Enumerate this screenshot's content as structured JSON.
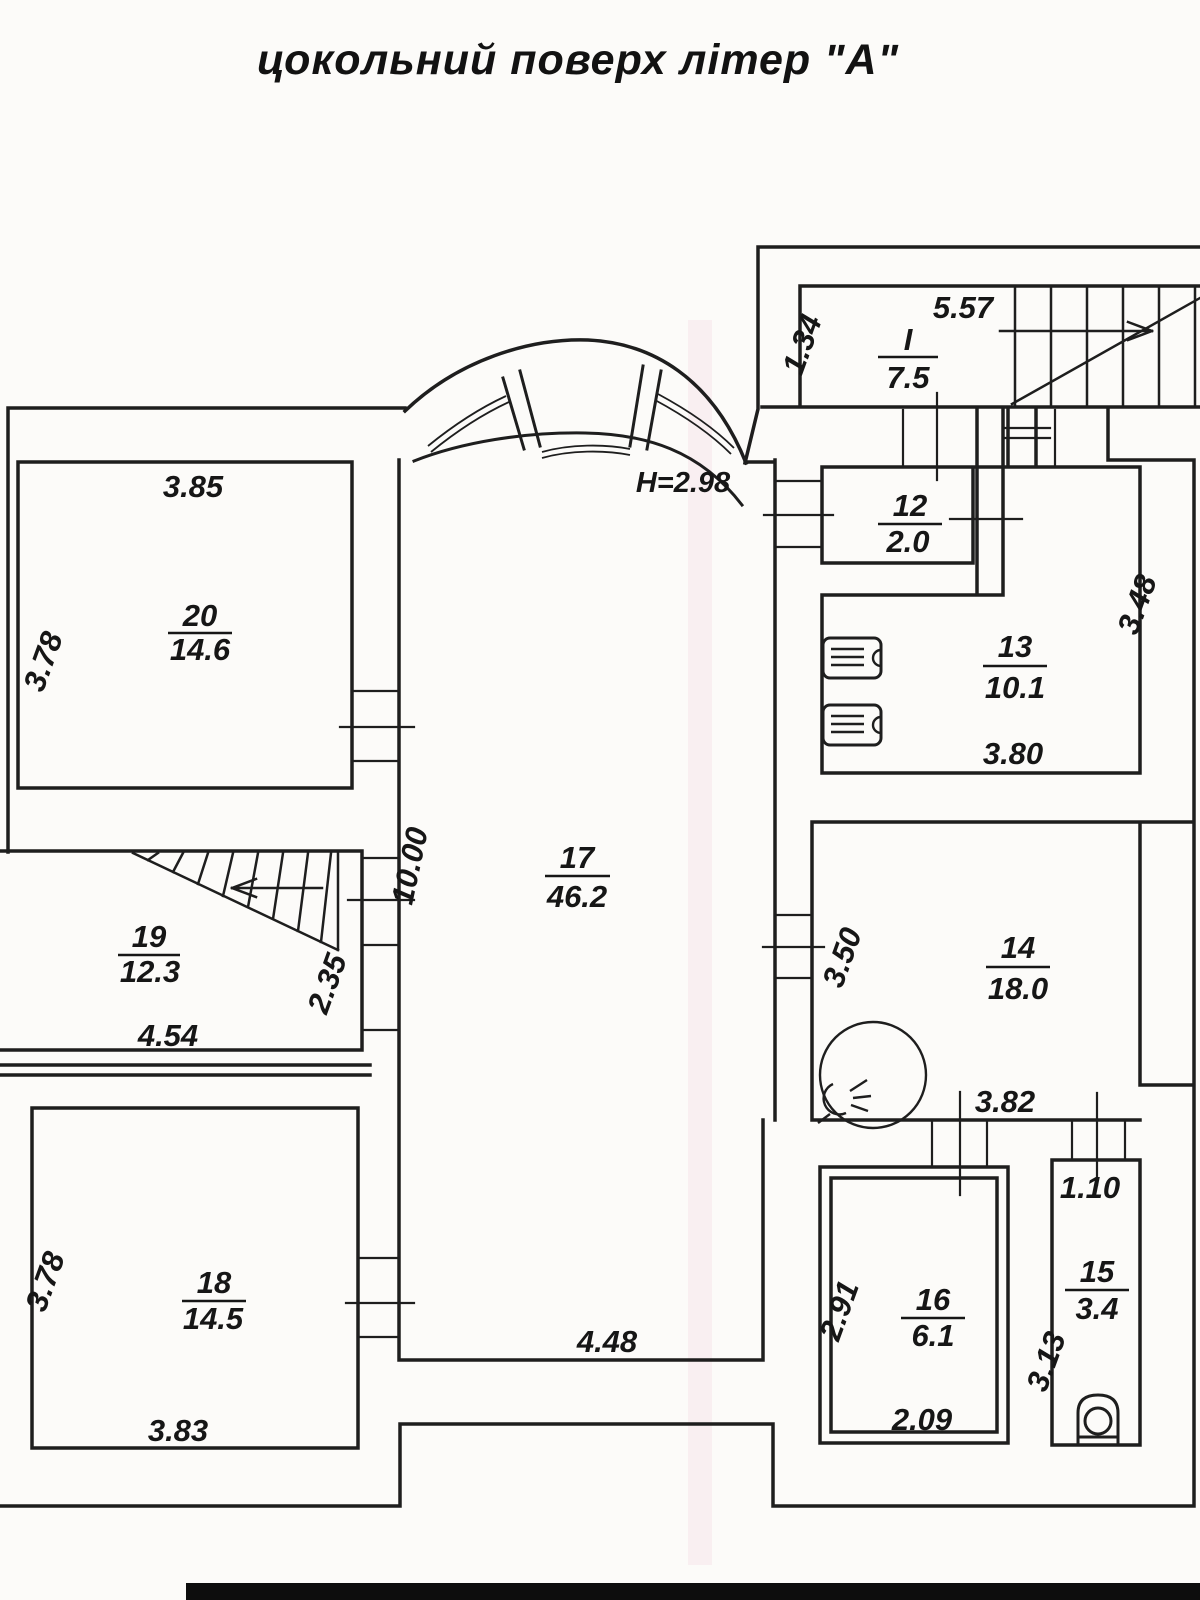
{
  "title": "цокольний поверх  літер \"А\"",
  "height_note": "Н=2.98",
  "rooms": [
    {
      "number": "20",
      "area": "14.6",
      "dim_top": "3.85",
      "dim_left": "3.78"
    },
    {
      "number": "19",
      "area": "12.3",
      "dim_bottom": "4.54",
      "dim_right": "2.35"
    },
    {
      "number": "18",
      "area": "14.5",
      "dim_left": "3.78",
      "dim_bottom": "3.83"
    },
    {
      "number": "17",
      "area": "46.2",
      "dim_left": "10.00",
      "dim_bottom": "4.48"
    },
    {
      "number": "I",
      "area": "7.5",
      "dim_left": "1.34",
      "dim_top": "5.57"
    },
    {
      "number": "12",
      "area": "2.0"
    },
    {
      "number": "13",
      "area": "10.1",
      "dim_right": "3.48",
      "dim_bottom": "3.80"
    },
    {
      "number": "14",
      "area": "18.0",
      "dim_left": "3.50",
      "dim_bottom": "3.82"
    },
    {
      "number": "15",
      "area": "3.4",
      "dim_top": "1.10",
      "dim_left": "3.13"
    },
    {
      "number": "16",
      "area": "6.1",
      "dim_left": "2.91",
      "dim_bottom": "2.09"
    }
  ]
}
